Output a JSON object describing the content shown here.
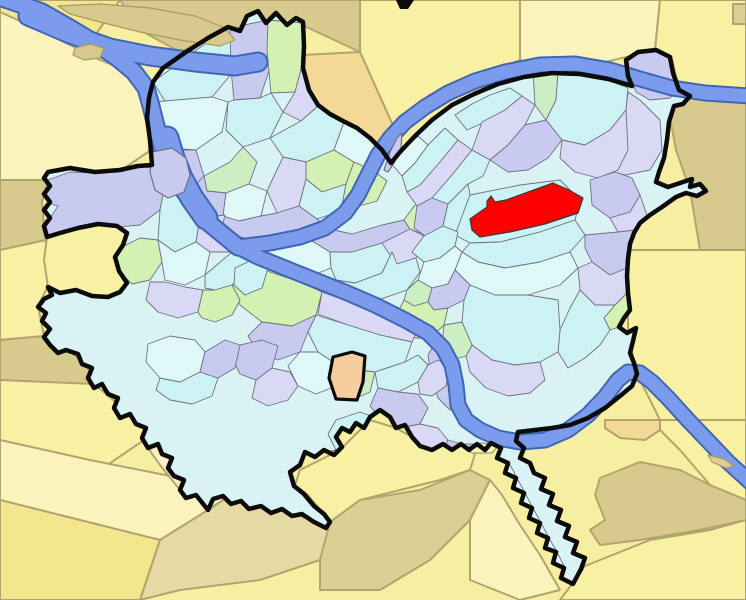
{
  "meta": {
    "kind": "city-neighborhood-locator-map",
    "description": "Locator map of city neighborhoods; pastel neighborhood mosaic inside thick black city boundary, surrounded by yellow municipalities, three rivers in blue, one neighborhood highlighted red",
    "width": 746,
    "height": 600
  },
  "palette": {
    "bg": "#F6EEA0",
    "yel": "#F8F0A2",
    "yel2": "#FAF4BC",
    "yel3": "#F3E68C",
    "tan": "#DCCF96",
    "tan2": "#E6DAA4",
    "khaki": "#D8CA8C",
    "org": "#F3D995",
    "cream": "#FAEFC9",
    "peach": "#F6CE9E",
    "cyan": "#CCF2F4",
    "cyan2": "#DEF8F8",
    "lav": "#C9CAEF",
    "lav2": "#D9D9F6",
    "grn": "#D3F1B2",
    "grn2": "#CBEFC2",
    "riverFill": "#7B9CEC",
    "riverEdge": "#4165B4",
    "nbStroke": "#6F7080",
    "munStroke": "#B2A46E",
    "outline": "#0B0B0B",
    "base": "#D9F2F4",
    "red": "#FE0000",
    "redStroke": "#3C3C3C",
    "islandStroke": "#A89A60"
  },
  "map": {
    "outside": [
      {
        "c": "yel3",
        "p": "0,0 120,0 96,34 40,26 0,16"
      },
      {
        "c": "khaki",
        "p": "120,0 360,0 360,52 300,24 230,28 180,52 140,30"
      },
      {
        "c": "yel",
        "p": "360,0 520,0 520,60 430,95 395,130 360,52"
      },
      {
        "c": "yel2",
        "p": "520,0 660,0 655,50 560,73 520,60"
      },
      {
        "c": "yel",
        "p": "660,0 746,0 746,96 680,92 672,60 655,50"
      },
      {
        "c": "tan",
        "p": "733,4 746,4 746,24 733,24"
      },
      {
        "c": "org",
        "p": "303,55 360,52 395,130 383,150 371,139 344,122 318,106 309,90 303,62"
      },
      {
        "c": "khaki",
        "p": "679,95 746,96 746,250 700,250 690,190 676,150 670,118"
      },
      {
        "c": "yel",
        "p": "628,250 746,250 746,420 660,420 636,372 628,330"
      },
      {
        "c": "yel2",
        "p": "0,12 40,30 100,60 150,80 152,102 151,150 120,171 95,173 70,172 48,180 0,180"
      },
      {
        "c": "khaki",
        "p": "0,180 48,180 42,202 44,226 46,240 0,250"
      },
      {
        "c": "yel",
        "p": "0,250 46,240 48,286 38,306 44,336 0,340"
      },
      {
        "c": "khaki",
        "p": "0,340 44,336 66,348 90,368 94,384 60,400 20,390 0,380"
      },
      {
        "c": "yel",
        "p": "0,380 94,384 130,414 150,416 144,440 100,470 40,450 0,440"
      },
      {
        "c": "yel2",
        "p": "0,440 90,460 170,476 196,495 208,510 160,540 80,520 0,500"
      },
      {
        "c": "yel3",
        "p": "0,500 80,520 160,540 140,600 0,600"
      },
      {
        "c": "tan2",
        "p": "160,540 208,510 226,498 252,500 280,508 310,520 330,528 320,560 260,580 180,590 140,600"
      },
      {
        "c": "yel",
        "p": "300,470 340,450 370,420 396,428 412,437 420,446 443,444 452,450 462,444 470,450 478,444 470,470 440,480 400,490 360,500 330,522 308,495 295,485"
      },
      {
        "c": "tan",
        "p": "320,560 330,522 360,500 420,490 470,470 490,480 470,520 430,560 380,590 320,590"
      },
      {
        "c": "yel2",
        "p": "470,520 490,480 502,495 520,525 540,555 560,590 520,600 470,580"
      },
      {
        "c": "yel",
        "p": "572,584 585,566 600,560 650,540 710,530 746,520 746,600 560,600"
      },
      {
        "c": "khaki",
        "p": "600,478 640,462 680,470 710,485 746,500 746,520 700,530 640,540 600,545 590,530 605,520 595,495"
      },
      {
        "c": "yel",
        "p": "660,420 746,420 746,500 710,485 680,450 660,430"
      },
      {
        "c": "org",
        "p": "605,420 660,420 660,430 645,440 620,438 605,428"
      },
      {
        "c": "cream",
        "p": "150,445 210,455 262,492 252,500 226,498 208,510 196,495 180,490 160,465 148,448"
      },
      {
        "c": "yel",
        "p": "48,287 60,293 76,290 92,296 108,297 120,292 127,283 119,271 115,257 123,245 127,233 117,226 98,224 78,228 60,233 47,237 44,260"
      }
    ],
    "city_outline": "152,165 150,140 147,118 149,98 153,82 163,68 186,52 208,38 228,27 240,31 247,16 258,11 266,23 276,13 287,25 296,18 303,22 304,46 303,68 309,90 318,105 330,114 343,121 357,128 370,138 382,150 391,163 400,152 415,136 432,120 452,105 474,94 498,84 524,77 552,73 580,74 608,79 632,86 628,76 626,60 638,52 656,50 670,57 673,73 679,90 690,96 683,104 674,106 669,122 667,140 664,158 659,172 656,182 668,187 680,183 692,179 690,187 700,184 706,191 697,196 686,193 676,197 662,207 650,215 640,223 634,233 630,244 628,259 627,276 628,293 630,310 624,318 619,327 627,333 636,328 633,341 630,353 634,363 637,374 632,386 620,396 605,408 588,418 570,425 552,428 535,430 518,432 516,441 524,448 520,458 530,463 534,473 545,478 541,489 553,494 549,505 561,510 557,521 569,526 565,537 577,542 573,553 585,558 581,569 573,584 561,578 564,568 553,563 556,552 545,548 548,538 537,533 540,523 529,518 532,508 521,503 524,493 513,488 516,478 505,473 508,463 497,458 501,448 491,443 485,450 477,444 469,450 461,444 452,450 443,444 432,450 420,446 412,437 405,425 396,428 390,417 380,410 370,417 364,428 356,423 350,432 342,428 336,437 342,447 334,455 324,450 315,457 305,452 300,465 290,472 294,486 304,494 314,506 324,514 330,522 326,528 314,522 302,514 292,516 282,509 271,513 261,506 249,509 241,501 231,504 223,496 213,499 208,510 196,495 186,498 180,490 184,480 174,476 168,468 172,458 162,454 158,444 148,448 142,438 146,428 136,424 130,414 120,418 114,408 118,398 108,394 102,384 94,388 88,378 92,368 82,364 78,354 66,350 58,353 50,345 44,337 50,329 42,321 46,313 38,307 44,299 52,295 48,287 60,293 76,290 92,296 108,297 120,292 127,283 119,271 115,257 123,245 127,233 117,226 98,224 78,228 60,233 47,237 44,226 50,218 44,210 50,202 44,194 50,186 44,178 48,172 70,168 95,172 120,170 138,166",
    "neighborhoods": [
      {
        "c": "cyan",
        "p": "153,82 210,40 230,28 233,72 212,97 168,106"
      },
      {
        "c": "lav",
        "p": "230,28 268,20 272,62 260,98 234,100 231,70"
      },
      {
        "c": "grn",
        "p": "268,20 303,23 303,62 295,92 271,93 267,50"
      },
      {
        "c": "lav2",
        "p": "295,92 303,62 309,92 318,106 301,121 283,112"
      },
      {
        "c": "cyan2",
        "p": "152,102 212,97 228,102 222,132 196,150 170,148 151,135"
      },
      {
        "c": "cyan",
        "p": "234,100 260,98 271,93 283,112 270,138 243,147 226,130 228,102"
      },
      {
        "c": "lav",
        "p": "151,150 196,150 204,176 188,193 163,186 151,168"
      },
      {
        "c": "grn2",
        "p": "204,176 230,162 243,147 257,162 249,184 226,193 207,191"
      },
      {
        "c": "cyan",
        "p": "270,138 301,121 318,106 331,115 344,122 334,150 306,162 283,157"
      },
      {
        "c": "grn",
        "p": "306,162 334,150 354,162 346,184 322,192 306,179"
      },
      {
        "c": "cyan2",
        "p": "344,122 358,129 371,139 383,151 374,171 354,162 334,150"
      },
      {
        "c": "lav",
        "p": "188,193 204,176 207,191 226,193 223,216 199,219 186,206"
      },
      {
        "c": "cyan2",
        "p": "226,193 249,184 267,191 261,216 239,221 223,216"
      },
      {
        "c": "lav2",
        "p": "267,191 283,157 306,162 306,179 299,206 277,213"
      },
      {
        "c": "cyan",
        "p": "299,206 306,179 322,192 346,184 341,211 317,219"
      },
      {
        "c": "grn",
        "p": "346,184 354,162 374,171 387,181 377,201 359,206 341,211"
      },
      {
        "c": "lav",
        "p": "223,216 239,221 261,216 277,213 299,206 317,219 329,229 316,241 286,244 257,241 236,236 221,229"
      },
      {
        "c": "cyan2",
        "p": "249,246 281,242 312,241 330,252 331,268 308,277 277,272 255,259"
      },
      {
        "c": "lav",
        "p": "312,241 329,229 352,234 382,225 404,220 410,229 382,243 352,252 330,252"
      },
      {
        "c": "cyan",
        "p": "331,268 330,252 352,252 382,243 392,252 382,273 355,283 336,280"
      },
      {
        "c": "lav2",
        "p": "382,243 410,229 424,236 416,258 397,264 388,252"
      },
      {
        "c": "grn",
        "p": "410,229 404,220 414,206 430,198 439,208 430,224 420,233"
      },
      {
        "c": "cyan",
        "p": "336,280 355,283 382,273 392,252 397,264 416,258 420,272 407,290 378,300 350,296 337,290"
      },
      {
        "c": "cyan2",
        "p": "391,163 403,150 418,136 428,145 415,163 402,176"
      },
      {
        "c": "cyan",
        "p": "402,176 415,163 428,145 445,128 458,140 440,162 420,185 407,192"
      },
      {
        "c": "lav2",
        "p": "407,192 420,185 440,162 458,140 472,150 452,175 432,198 417,206"
      },
      {
        "c": "cyan",
        "p": "455,115 472,104 490,95 510,88 522,96 505,110 485,122 467,130"
      },
      {
        "c": "lav2",
        "p": "472,150 482,122 505,110 522,96 535,105 525,125 508,145 490,160"
      },
      {
        "c": "grn2",
        "p": "535,105 533,70 545,66 558,72 556,100 546,120"
      },
      {
        "c": "cyan",
        "p": "546,120 556,100 558,72 580,74 605,79 628,88 626,110 610,130 585,145 562,140"
      },
      {
        "c": "lav2",
        "p": "585,148 610,130 626,110 628,92 640,100 660,120 662,150 650,170 625,175 600,168"
      },
      {
        "c": "lav",
        "p": "490,160 508,145 525,125 546,120 562,140 548,158 528,170 508,172"
      },
      {
        "c": "cyan",
        "p": "432,198 452,175 472,150 490,160 483,176 468,184 448,204"
      },
      {
        "c": "lav",
        "p": "417,206 432,198 448,204 443,226 428,238 414,228"
      },
      {
        "c": "cyan",
        "p": "443,226 448,204 468,184 470,195 468,215 458,232"
      },
      {
        "c": "lav2",
        "p": "562,140 585,145 610,130 626,110 628,150 618,170 598,178 575,172 560,158"
      },
      {
        "c": "lav",
        "p": "590,180 615,172 632,178 640,195 630,212 610,218 592,205"
      },
      {
        "c": "lav2",
        "p": "610,218 630,212 640,195 648,218 636,230 618,232"
      },
      {
        "c": "cyan",
        "p": "455,235 470,195 520,185 560,180 580,200 575,220 540,232 500,242 470,243"
      },
      {
        "c": "cyan",
        "p": "470,243 500,242 540,232 575,220 585,235 570,252 540,262 505,268 478,262 462,252"
      },
      {
        "c": "lav",
        "p": "585,235 618,232 636,230 628,247 627,268 610,275 592,262 585,248"
      },
      {
        "c": "cyan2",
        "p": "462,252 478,262 505,268 540,262 570,252 578,268 560,285 528,295 495,295 470,285 455,270"
      },
      {
        "c": "lav2",
        "p": "578,268 592,262 610,275 627,268 628,292 615,305 595,305 580,290"
      },
      {
        "c": "grn",
        "p": "615,305 628,292 630,310 624,318 619,327 610,330 604,318"
      },
      {
        "c": "cyan",
        "p": "580,290 595,305 615,305 604,318 610,330 600,345 585,358 568,368 558,352 560,330 570,308"
      },
      {
        "c": "cyan",
        "p": "412,252 424,236 443,226 458,232 455,246 440,258 424,262"
      },
      {
        "c": "cyan2",
        "p": "424,262 440,258 455,246 462,252 455,270 448,284 432,288 418,280"
      },
      {
        "c": "grn2",
        "p": "407,290 418,280 432,288 428,302 414,306 404,300"
      },
      {
        "c": "lav",
        "p": "428,302 432,288 448,284 455,270 470,285 464,300 448,308 434,310"
      },
      {
        "c": "cyan",
        "p": "464,300 470,285 495,295 528,295 558,300 560,330 558,352 540,362 515,365 492,360 472,345 462,322"
      },
      {
        "c": "lav2",
        "p": "472,345 492,360 515,365 540,362 545,380 530,393 508,396 486,388 470,372 466,356"
      },
      {
        "c": "grn",
        "p": "404,300 414,306 428,302 434,310 448,308 444,325 430,338 415,338 404,325 398,312"
      },
      {
        "c": "grn2",
        "p": "444,325 462,322 472,345 466,356 452,360 442,345"
      },
      {
        "c": "lav",
        "p": "434,345 452,360 458,378 462,402 450,410 438,398 430,372 428,355"
      },
      {
        "c": "grn",
        "p": "240,262 270,272 300,282 322,292 316,315 292,326 262,322 240,305 232,284"
      },
      {
        "c": "lav2",
        "p": "322,292 352,303 385,315 418,328 412,342 380,335 348,325 318,314"
      },
      {
        "c": "cyan",
        "p": "316,315 348,325 380,335 412,342 405,362 375,372 342,368 318,352 308,332"
      },
      {
        "c": "lav",
        "p": "262,322 292,326 316,315 308,332 300,352 278,360 258,352 248,336"
      },
      {
        "c": "cyan2",
        "p": "300,352 318,352 342,368 336,386 316,394 298,386 288,366"
      },
      {
        "c": "grn2",
        "p": "342,368 375,372 370,392 352,400 336,386"
      },
      {
        "c": "cyan",
        "p": "375,372 405,362 418,355 428,365 418,382 398,392 378,388"
      },
      {
        "c": "lav2",
        "p": "418,382 428,365 438,360 450,368 446,386 432,396 420,394"
      },
      {
        "c": "lav",
        "p": "378,388 398,392 418,394 428,408 420,424 400,428 382,420 370,406"
      },
      {
        "c": "cyan",
        "p": "336,420 360,412 382,420 400,428 396,448 378,462 354,464 336,450 328,434"
      },
      {
        "c": "lav2",
        "p": "400,428 420,424 438,428 448,440 442,452 424,458 406,450 396,448"
      },
      {
        "c": "grn",
        "p": "336,450 354,464 348,480 332,490 314,484 308,468 318,454"
      },
      {
        "c": "lav",
        "p": "442,452 448,440 462,444 478,444 492,443 498,458 490,470 472,472 456,466 446,460"
      },
      {
        "c": "cyan2",
        "p": "498,458 509,463 517,478 525,493 533,508 541,523 549,538 557,552 565,568 562,578 548,570 540,555 530,540 520,525 510,510 502,495 494,480 490,470"
      },
      {
        "c": "lav",
        "p": "240,345 262,340 278,346 272,368 256,380 240,374 232,358"
      },
      {
        "c": "lav2",
        "p": "256,380 272,368 290,372 298,386 288,400 268,406 252,398"
      },
      {
        "c": "cyan",
        "p": "160,378 180,382 200,372 218,378 212,396 192,404 170,400 156,390"
      },
      {
        "c": "lav",
        "p": "48,180 70,172 95,173 138,166 152,168 165,185 160,210 140,225 118,227 100,225 80,229 60,235 48,238 44,226 50,218 58,206 44,202 48,186"
      },
      {
        "c": "cyan",
        "p": "160,210 165,185 190,192 200,218 196,242 175,252 158,240"
      },
      {
        "c": "lav2",
        "p": "200,218 225,215 222,228 238,235 232,252 210,252 196,242"
      },
      {
        "c": "grn",
        "p": "124,246 140,238 158,240 162,262 150,280 132,284 120,272 116,258"
      },
      {
        "c": "cyan2",
        "p": "158,240 175,252 196,242 210,252 205,275 185,285 165,280 162,262"
      },
      {
        "c": "cyan",
        "p": "205,275 232,252 238,235 252,248 248,270 232,285 215,290 205,288"
      },
      {
        "c": "lav2",
        "p": "150,282 165,282 185,287 203,290 198,312 178,318 158,312 146,300"
      },
      {
        "c": "grn",
        "p": "198,312 203,290 215,290 232,285 240,300 232,315 215,322 202,318"
      },
      {
        "c": "cyan2",
        "p": "148,344 170,336 195,340 205,352 200,372 180,382 160,378 146,362"
      },
      {
        "c": "lav",
        "p": "205,352 225,340 240,345 235,368 218,378 200,372"
      },
      {
        "c": "cyan",
        "p": "235,268 252,260 268,268 262,288 245,295 234,285"
      },
      {
        "c": "lav",
        "p": "628,60 638,53 656,51 668,57 672,73 678,90 670,98 650,100 636,92 630,76"
      }
    ],
    "rivers": [
      {
        "d": "M238,247 L210,224 196,208 182,188 170,166 162,146 156,126 151,106 146,88 134,72 116,57 95,43 70,28 42,12 14,2 -4,-4",
        "w": 15
      },
      {
        "d": "M206,218 L192,198 181,178 173,158 167,138",
        "w": 21
      },
      {
        "d": "M28,16 L70,34 110,48 150,56 195,62 235,66 258,62",
        "w": 17
      },
      {
        "d": "M238,247 L270,243 300,237 325,228 345,213 358,195 368,175 378,155 390,138 405,122 425,107 448,93 475,81 505,72 540,65 575,64 610,70 640,79 672,88 705,93 750,96",
        "w": 13
      },
      {
        "d": "M238,247 L258,257 285,268 315,280 345,292 375,305 405,320 428,333 443,348 452,365 456,385 458,405 466,420 480,430 498,438 520,442 545,440 568,430 588,415 605,397 618,380 628,372 640,373 652,382 668,398 688,420 710,443 728,462 750,482",
        "w": 13
      }
    ],
    "islands": [
      {
        "c": "khaki",
        "s": "islandStroke",
        "p": "58,6 100,4 150,8 195,16 225,28 235,40 220,46 180,40 140,32 100,22 70,14"
      },
      {
        "c": "khaki",
        "s": "islandStroke",
        "p": "75,48 90,44 104,48 100,58 84,60 73,55"
      },
      {
        "c": "lav",
        "s": "nbStroke",
        "p": "152,152 172,148 186,158 190,175 184,192 168,198 155,190 150,172"
      },
      {
        "c": "lav",
        "s": "nbStroke",
        "p": "384,170 390,152 397,138 402,133 401,148 394,163 388,172"
      },
      {
        "c": "yel2",
        "s": "islandStroke",
        "p": "465,448 482,443 498,446 492,453 472,453"
      },
      {
        "c": "tan",
        "s": "islandStroke",
        "p": "708,455 724,459 734,466 726,468 712,462"
      }
    ],
    "enclaves": [
      {
        "c": "peach",
        "p": "333,357 352,352 365,356 363,382 357,400 336,399 329,378"
      }
    ],
    "highlight": {
      "c": "red",
      "p": "470,219 487,207 487,201 491,196 495,202 506,200 553,183 569,190 583,198 578,213 545,224 510,232 480,237 472,230"
    },
    "marks": [
      {
        "c": "#0B0B0B",
        "p": "396,0 414,0 408,9 400,9"
      }
    ]
  }
}
